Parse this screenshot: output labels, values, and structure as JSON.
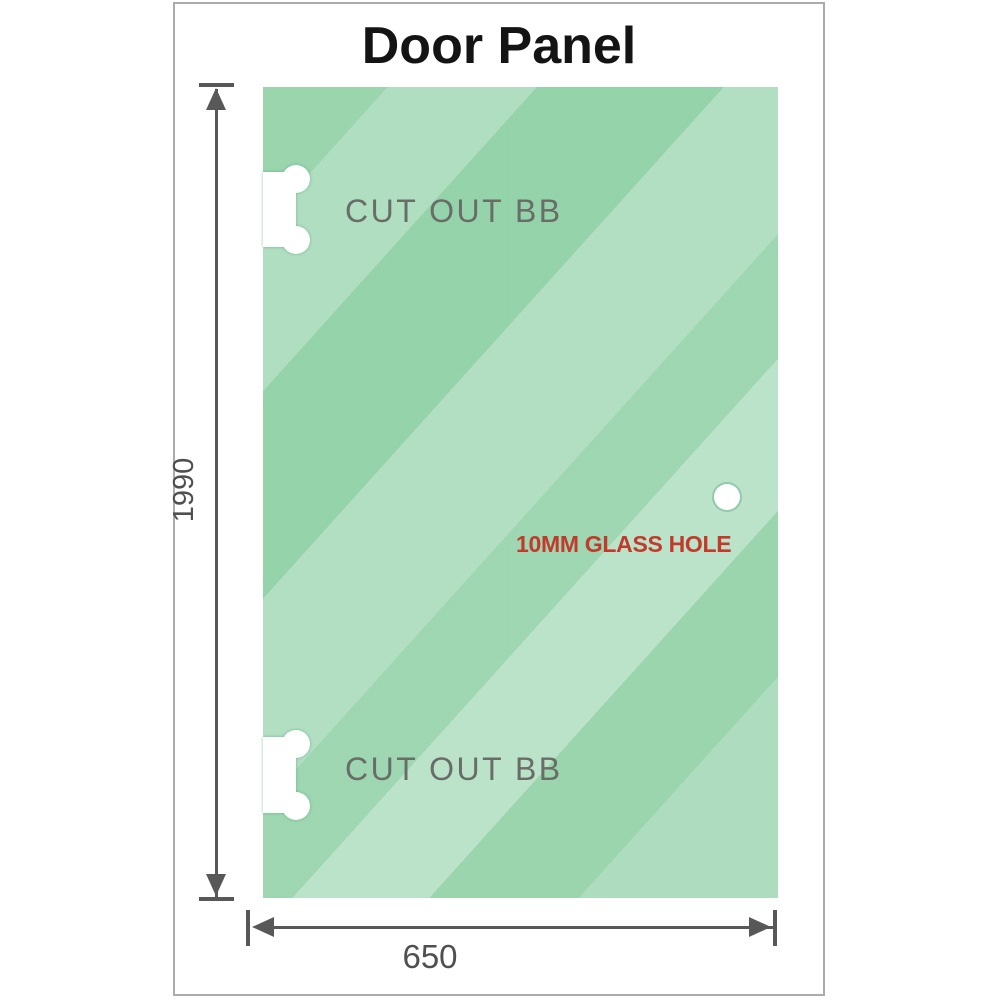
{
  "title": "Door Panel",
  "panel": {
    "glass_color": "#8ed0a5",
    "cutout_top_label": "CUT OUT BB",
    "cutout_bottom_label": "CUT OUT BB",
    "glass_hole_label": "10MM GLASS HOLE",
    "glass_hole_label_color": "#c23a2c",
    "cutout_label_color": "#686d68"
  },
  "dimensions": {
    "height_label": "1990",
    "width_label": "650",
    "line_color": "#585858"
  }
}
